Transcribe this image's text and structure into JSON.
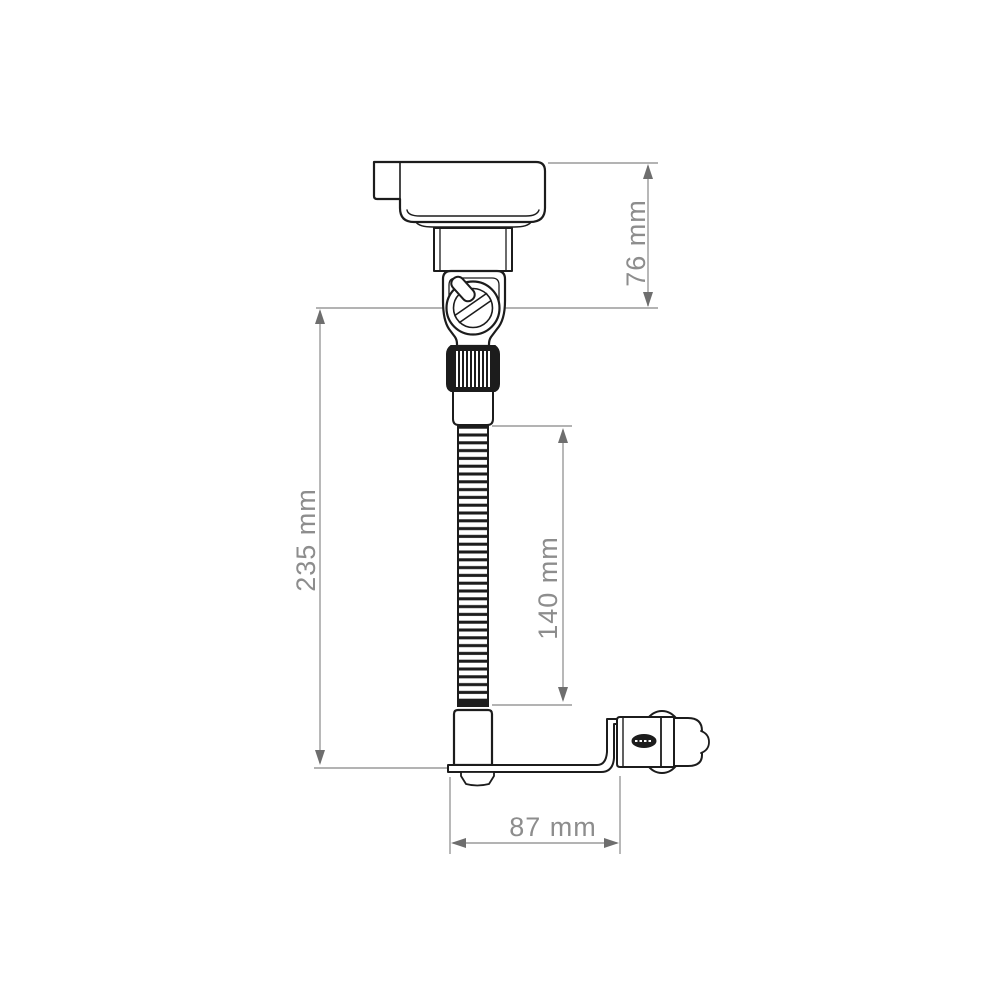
{
  "diagram": {
    "background_color": "#ffffff",
    "outline_color": "#1c1c1c",
    "dimension_line_color": "#9a9a9a",
    "dimension_arrow_color": "#6e6e6e",
    "dimension_text_color": "#8d8d8d",
    "unit": "mm",
    "dimensions": {
      "head_height": {
        "label": "76 mm",
        "value": 76,
        "orientation": "vertical"
      },
      "overall_height": {
        "label": "235 mm",
        "value": 235,
        "orientation": "vertical"
      },
      "gooseneck_length": {
        "label": "140 mm",
        "value": 140,
        "orientation": "vertical"
      },
      "base_depth": {
        "label": "87 mm",
        "value": 87,
        "orientation": "horizontal"
      }
    },
    "parts": [
      "head unit",
      "clamp housing with thumbscrew",
      "locking pin",
      "knurled collar",
      "flexible gooseneck tube",
      "base block",
      "mounting bracket arm",
      "cigarette lighter plug"
    ]
  }
}
